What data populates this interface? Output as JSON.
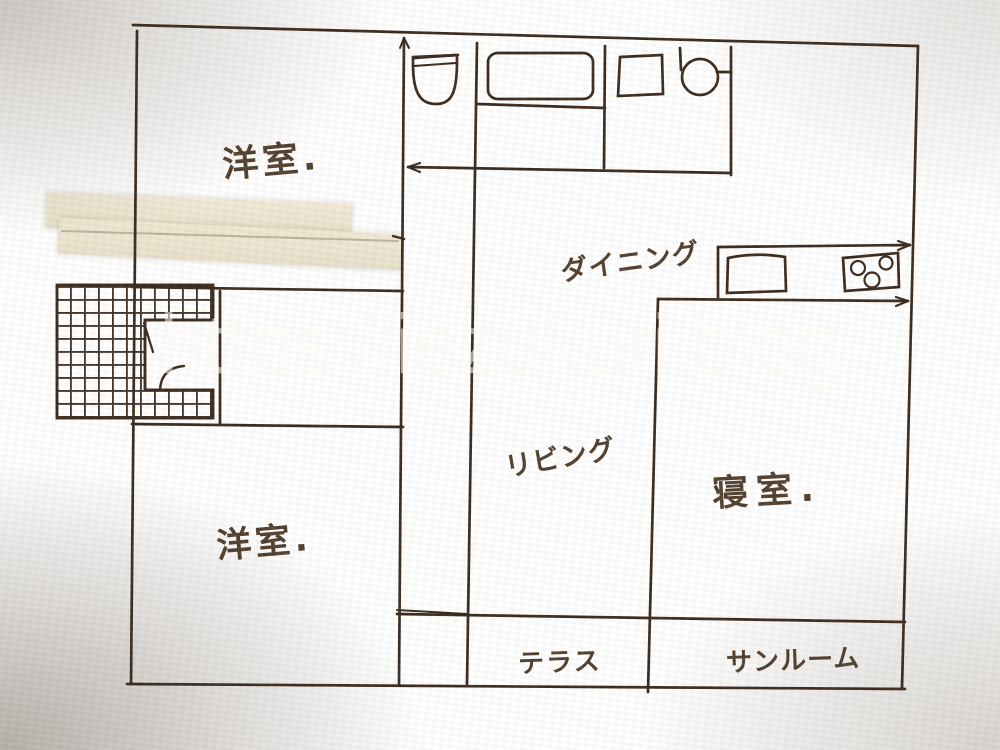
{
  "image_type": "hand-drawn house floor plan sketch, photographed on beige paper",
  "watermark": {
    "text": "https://iezukuri.blog",
    "color": "#ffffff",
    "opacity": 0.55
  },
  "rooms": [
    {
      "id": "yoshitsu-upper",
      "label": "洋室.",
      "meaning": "western-style room (upper left)"
    },
    {
      "id": "yoshitsu-lower",
      "label": "洋室.",
      "meaning": "western-style room (lower left)"
    },
    {
      "id": "dining",
      "label": "ダイニング",
      "meaning": "dining"
    },
    {
      "id": "living",
      "label": "リビング",
      "meaning": "living"
    },
    {
      "id": "bedroom",
      "label": "寝室.",
      "meaning": "bedroom"
    },
    {
      "id": "terrace",
      "label": "テラス",
      "meaning": "terrace"
    },
    {
      "id": "sunroom",
      "label": "サンルーム",
      "meaning": "sunroom"
    }
  ],
  "fixtures": [
    {
      "id": "toilet-icon",
      "name": "toilet bowl with tank"
    },
    {
      "id": "bathtub-icon",
      "name": "bathtub"
    },
    {
      "id": "washing-machine-icon",
      "name": "washing machine (square)"
    },
    {
      "id": "wash-basin-icon",
      "name": "round wash basin"
    },
    {
      "id": "kitchen-sink-icon",
      "name": "kitchen sink"
    },
    {
      "id": "stove-icon",
      "name": "3-burner stove"
    },
    {
      "id": "staircase-icon",
      "name": "hatched U-shaped staircase"
    },
    {
      "id": "masking-tape",
      "name": "two strips of masking tape on paper"
    }
  ],
  "colors": {
    "ink": "#3b2a1d",
    "paper_center": "#d6c7ac",
    "paper_edge": "#96866b",
    "tape": "#ece4cd",
    "label_ink": "#45301d"
  }
}
